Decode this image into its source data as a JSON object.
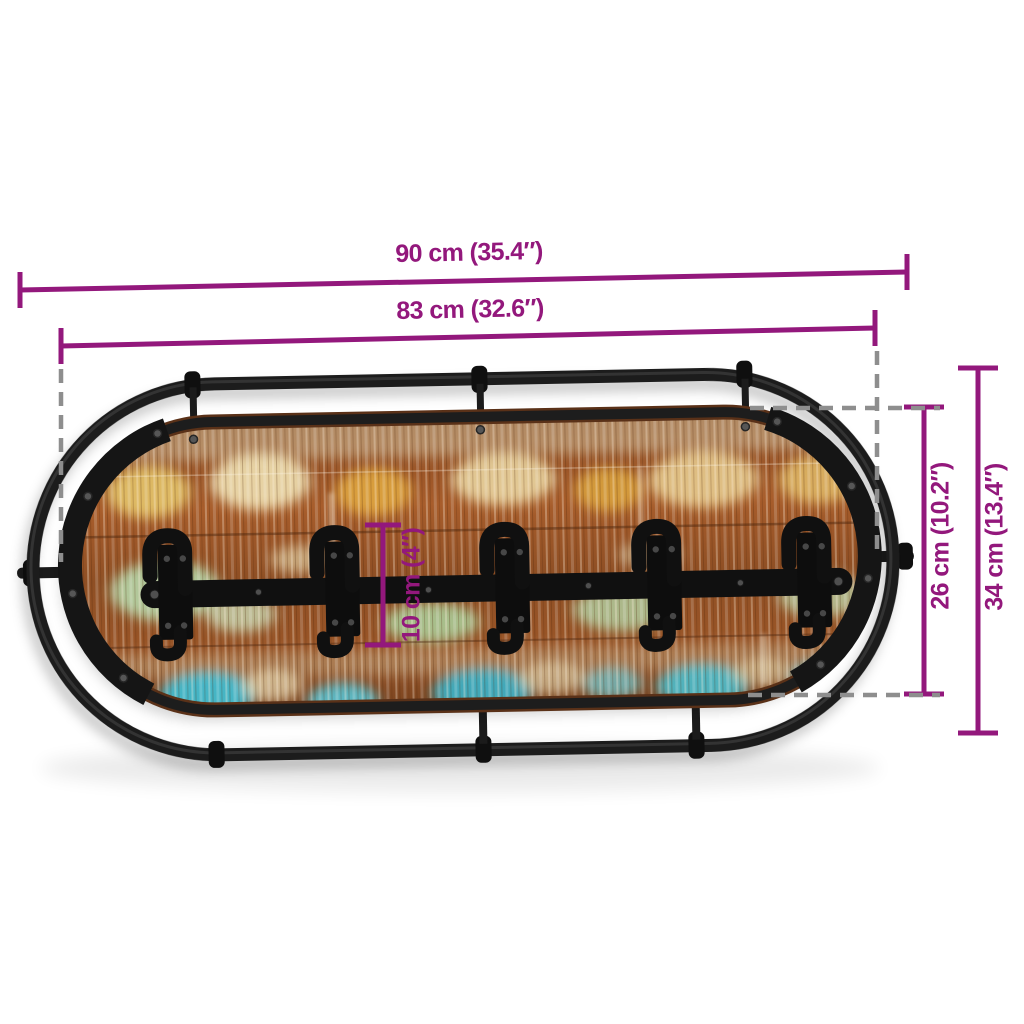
{
  "page": {
    "background": "#ffffff",
    "kind": "product dimension diagram"
  },
  "product": {
    "name": "wall-mounted coat rack",
    "frame": "oval black metal tube frame with side stubs",
    "panel": "oval reclaimed wood board with multicolour paint",
    "hook_rail": "black metal rail",
    "hook_assemblies": 5,
    "hooks_per_assembly": 2
  },
  "dimension_labels": {
    "overall_width": "90 cm (35.4″)",
    "frame_width": "83 cm (32.6″)",
    "panel_height": "26 cm (10.2″)",
    "overall_height": "34 cm (13.4″)",
    "hook_height": "10 cm (4″)"
  },
  "colors": {
    "annotation_magenta": "#93187C",
    "guide_dashed_gray": "#8E8E8E",
    "metal_black": "#1C1C1C",
    "wood_base_brown": "#9C5626",
    "paint_yellow": "#E2AE45",
    "paint_cream": "#EADCAF",
    "paint_green": "#B2D8A8",
    "paint_turquoise": "#3FC0D6"
  }
}
